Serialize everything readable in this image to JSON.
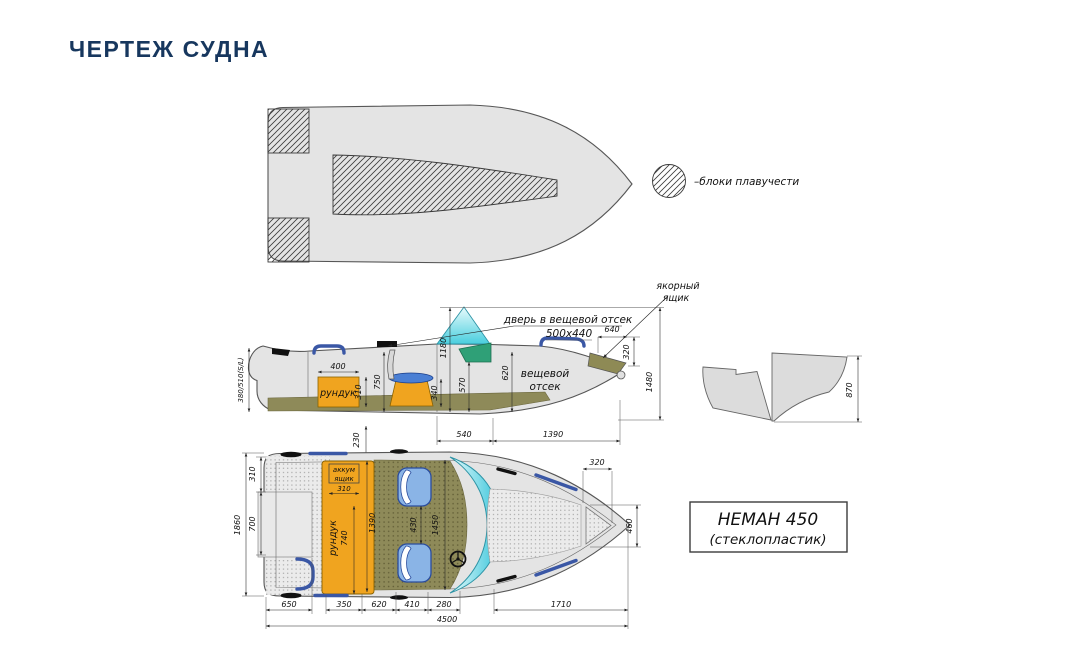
{
  "page": {
    "title": "ЧЕРТЕЖ СУДНА"
  },
  "legend": {
    "buoyancy": "–блоки плавучести"
  },
  "side_view": {
    "stern_height": "380/510(S/L)",
    "locker_label": "рундук",
    "locker_width": "400",
    "locker_height": "310",
    "d750": "750",
    "d1180": "1180",
    "d340": "340",
    "d570": "570",
    "d620": "620",
    "door_label": "дверь в вещевой отсек",
    "door_size": "500х440",
    "d640": "640",
    "d320": "320",
    "d1480": "1480",
    "anchor_line1": "якорный",
    "anchor_line2": "ящик",
    "storage_line1": "вещевой",
    "storage_line2": "отсек",
    "d540": "540",
    "d1390": "1390",
    "d230": "230"
  },
  "transom_view": {
    "d870": "870"
  },
  "plan_view": {
    "beam": "1860",
    "d310_side": "310",
    "d700": "700",
    "battery_line1": "аккум",
    "battery_line2": "ящик",
    "battery_width": "310",
    "locker_label": "рундук",
    "locker_length": "740",
    "cockpit_width": "1390",
    "seat_gap": "430",
    "d1450": "1450",
    "bow_hatch_width": "320",
    "bow_hatch_height": "460",
    "d650": "650",
    "d350": "350",
    "d620": "620",
    "d410": "410",
    "d280": "280",
    "d1710": "1710",
    "total_length": "4500"
  },
  "title_block": {
    "model": "НЕМАН 450",
    "material": "(стеклопластик)"
  }
}
